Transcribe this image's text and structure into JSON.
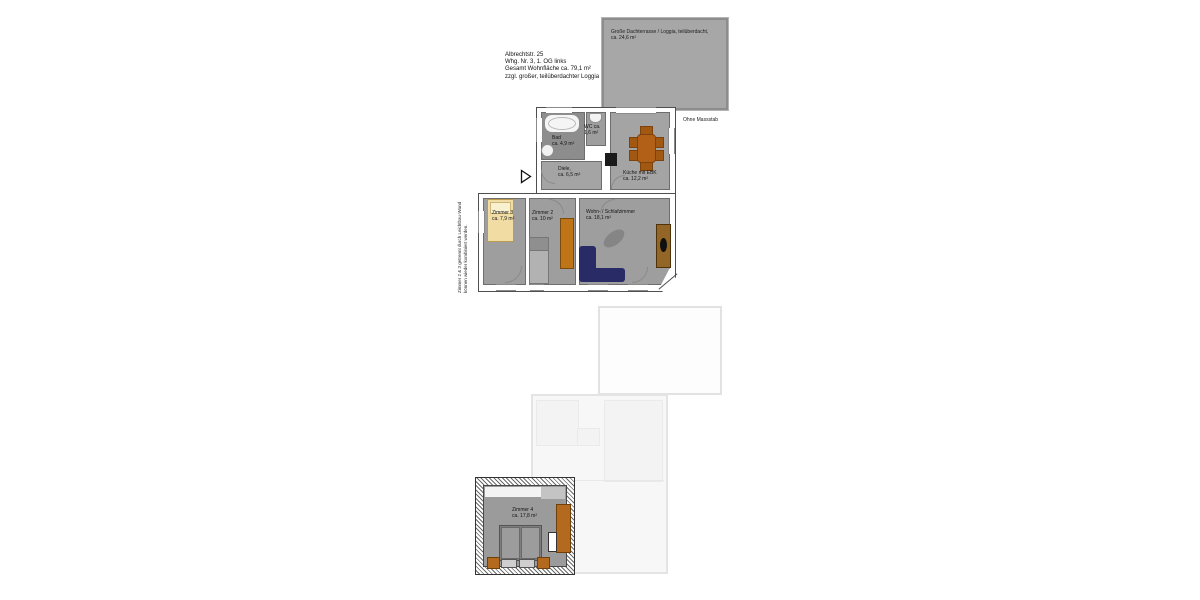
{
  "floor1": {
    "header_lines": [
      "Albrechtstr. 25",
      "Whg. Nr. 3, 1. OG links",
      "Gesamt Wohnfläche ca. 79,1 m²",
      "zzgl. großer, teilüberdachter Loggia"
    ],
    "scale_note": "Ohne Massstab",
    "partition_note_line1": "Zimmer 2 & 3 getrennt durch Leichtbau-Wand",
    "partition_note_line2": "können wieder kombiniert werden.",
    "terrace": {
      "name": "Große Dachterrasse / Loggia, teilüberdacht,",
      "area": "ca. 24,6 m²"
    },
    "rooms": {
      "bad": {
        "name": "Bad",
        "area": "ca. 4,9 m²"
      },
      "wc": {
        "name": "WC ca.",
        "area": "1,6 m²"
      },
      "diele": {
        "name": "Diele,",
        "area": "ca. 6,5 m²"
      },
      "kueche": {
        "name": "Küche mit EBK",
        "area": "ca. 12,2 m²"
      },
      "zimmer3": {
        "name": "Zimmer 3",
        "area": "ca. 7,9 m²"
      },
      "zimmer2": {
        "name": "Zimmer 2",
        "area": "ca. 10 m²"
      },
      "wohnschlaf": {
        "name": "Wohn- / Schlafzimmer",
        "area": "ca. 18,1 m²"
      }
    }
  },
  "floor2": {
    "zimmer4": {
      "name": "Zimmer 4",
      "area": "ca. 17,8 m²"
    }
  },
  "colors": {
    "room_gray": "#9e9e9e",
    "bad_gray": "#8d8d8d",
    "terrace_gray": "#a7a7a7",
    "furniture_orange": "#b4671c",
    "sofa_navy": "#282b66",
    "bed_yellow": "#f1dda4",
    "ghost_outline": "#e4e4e4"
  }
}
